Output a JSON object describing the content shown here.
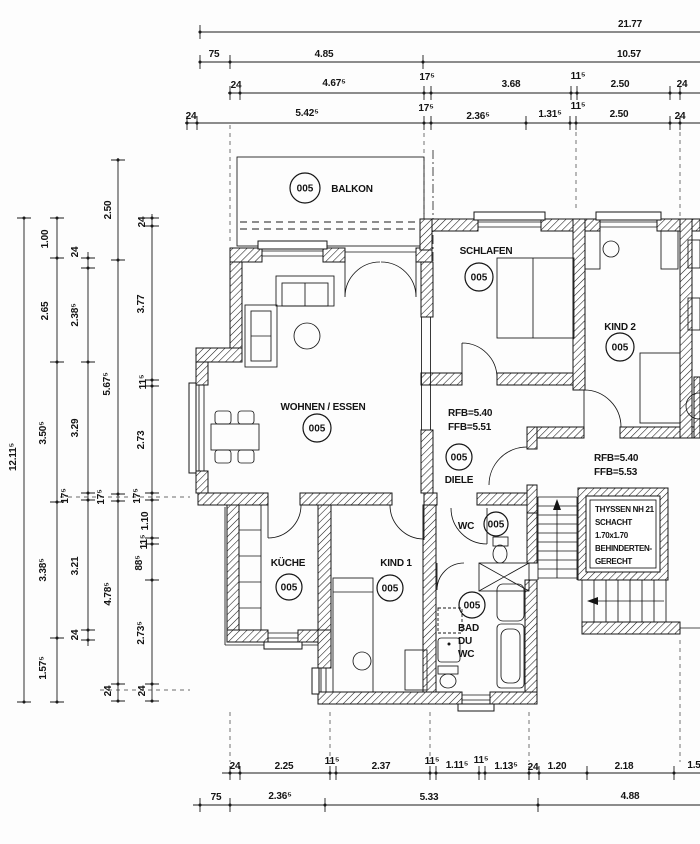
{
  "drawing_title": "Wohnungsgrundriss",
  "room_labels": [
    {
      "text": "BALKON",
      "x": 352,
      "y": 192
    },
    {
      "text": "SCHLAFEN",
      "x": 486,
      "y": 254
    },
    {
      "text": "KIND 2",
      "x": 620,
      "y": 330
    },
    {
      "text": "WOHNEN / ESSEN",
      "x": 323,
      "y": 410
    },
    {
      "text": "KÜCHE",
      "x": 288,
      "y": 566
    },
    {
      "text": "KIND 1",
      "x": 396,
      "y": 566
    },
    {
      "text": "DIELE",
      "x": 459,
      "y": 483
    },
    {
      "text": "WC",
      "x": 466,
      "y": 529
    }
  ],
  "room_tags": [
    {
      "text": "005",
      "x": 305,
      "y": 188,
      "r": 15
    },
    {
      "text": "005",
      "x": 479,
      "y": 277,
      "r": 14
    },
    {
      "text": "005",
      "x": 620,
      "y": 347,
      "r": 14
    },
    {
      "text": "005",
      "x": 317,
      "y": 428,
      "r": 14
    },
    {
      "text": "005",
      "x": 289,
      "y": 587,
      "r": 13
    },
    {
      "text": "005",
      "x": 390,
      "y": 588,
      "r": 13
    },
    {
      "text": "005",
      "x": 459,
      "y": 457,
      "r": 13
    },
    {
      "text": "005",
      "x": 496,
      "y": 524,
      "r": 12
    },
    {
      "text": "005",
      "x": 472,
      "y": 605,
      "r": 13
    }
  ],
  "annotations": [
    {
      "text": "RFB=5.40",
      "x": 448,
      "y": 416
    },
    {
      "text": "FFB=5.51",
      "x": 448,
      "y": 430
    },
    {
      "text": "RFB=5.40",
      "x": 594,
      "y": 461
    },
    {
      "text": "FFB=5.53",
      "x": 594,
      "y": 475
    },
    {
      "text": "BAD",
      "x": 458,
      "y": 631
    },
    {
      "text": "DU",
      "x": 458,
      "y": 644
    },
    {
      "text": "WC",
      "x": 458,
      "y": 657
    },
    {
      "text": "THYSSEN NH 21",
      "x": 595,
      "y": 512,
      "cls": "small"
    },
    {
      "text": "SCHACHT",
      "x": 595,
      "y": 525,
      "cls": "small"
    },
    {
      "text": "1.70x1.70",
      "x": 595,
      "y": 538,
      "cls": "small"
    },
    {
      "text": "BEHINDERTEN-",
      "x": 595,
      "y": 551,
      "cls": "small"
    },
    {
      "text": "GERECHT",
      "x": 595,
      "y": 564,
      "cls": "small"
    }
  ],
  "dims_top": [
    {
      "text": "21.77",
      "x": 630,
      "y": 27
    },
    {
      "text": "75",
      "x": 214,
      "y": 57
    },
    {
      "text": "4.85",
      "x": 324,
      "y": 57
    },
    {
      "text": "10.57",
      "x": 629,
      "y": 57
    },
    {
      "text": "24",
      "x": 236,
      "y": 88
    },
    {
      "text": "4.67⁵",
      "x": 334,
      "y": 86
    },
    {
      "text": "17⁵",
      "x": 427,
      "y": 80
    },
    {
      "text": "3.68",
      "x": 511,
      "y": 87
    },
    {
      "text": "11⁵",
      "x": 578,
      "y": 79
    },
    {
      "text": "2.50",
      "x": 620,
      "y": 87
    },
    {
      "text": "24",
      "x": 682,
      "y": 87
    },
    {
      "text": "24",
      "x": 191,
      "y": 119
    },
    {
      "text": "5.42⁵",
      "x": 307,
      "y": 116
    },
    {
      "text": "17⁵",
      "x": 426,
      "y": 111
    },
    {
      "text": "2.36⁵",
      "x": 478,
      "y": 119
    },
    {
      "text": "1.31⁵",
      "x": 550,
      "y": 117
    },
    {
      "text": "11⁵",
      "x": 578,
      "y": 109
    },
    {
      "text": "2.50",
      "x": 619,
      "y": 117
    },
    {
      "text": "24",
      "x": 680,
      "y": 119
    }
  ],
  "dims_bottom": [
    {
      "text": "24",
      "x": 235,
      "y": 769
    },
    {
      "text": "2.25",
      "x": 284,
      "y": 769
    },
    {
      "text": "11⁵",
      "x": 332,
      "y": 764
    },
    {
      "text": "2.37",
      "x": 381,
      "y": 769
    },
    {
      "text": "11⁵",
      "x": 432,
      "y": 764
    },
    {
      "text": "1.11⁵",
      "x": 457,
      "y": 768
    },
    {
      "text": "11⁵",
      "x": 481,
      "y": 763
    },
    {
      "text": "1.13⁵",
      "x": 506,
      "y": 769
    },
    {
      "text": "24",
      "x": 533,
      "y": 770
    },
    {
      "text": "1.20",
      "x": 557,
      "y": 769
    },
    {
      "text": "2.18",
      "x": 624,
      "y": 769
    },
    {
      "text": "1.5",
      "x": 694,
      "y": 768
    },
    {
      "text": "75",
      "x": 216,
      "y": 800
    },
    {
      "text": "2.36⁵",
      "x": 280,
      "y": 799
    },
    {
      "text": "5.33",
      "x": 429,
      "y": 800
    },
    {
      "text": "4.88",
      "x": 630,
      "y": 799
    }
  ],
  "dims_left": [
    {
      "text": "12.11⁵",
      "x": 16,
      "y": 457,
      "rot": -90
    },
    {
      "text": "1.00",
      "x": 48,
      "y": 239,
      "rot": -90
    },
    {
      "text": "2.65",
      "x": 48,
      "y": 311,
      "rot": -90
    },
    {
      "text": "3.50⁵",
      "x": 46,
      "y": 433,
      "rot": -90
    },
    {
      "text": "3.38⁵",
      "x": 46,
      "y": 570,
      "rot": -90
    },
    {
      "text": "1.57⁵",
      "x": 46,
      "y": 668,
      "rot": -90
    },
    {
      "text": "24",
      "x": 78,
      "y": 252,
      "rot": -90
    },
    {
      "text": "2.38⁵",
      "x": 78,
      "y": 315,
      "rot": -90
    },
    {
      "text": "3.29",
      "x": 78,
      "y": 428,
      "rot": -90
    },
    {
      "text": "17⁵",
      "x": 68,
      "y": 496,
      "rot": -90
    },
    {
      "text": "3.21",
      "x": 78,
      "y": 566,
      "rot": -90
    },
    {
      "text": "24",
      "x": 78,
      "y": 635,
      "rot": -90
    },
    {
      "text": "2.50",
      "x": 111,
      "y": 210,
      "rot": -90
    },
    {
      "text": "5.67⁵",
      "x": 110,
      "y": 384,
      "rot": -90
    },
    {
      "text": "17⁵",
      "x": 104,
      "y": 497,
      "rot": -90
    },
    {
      "text": "4.78⁵",
      "x": 111,
      "y": 594,
      "rot": -90
    },
    {
      "text": "24",
      "x": 111,
      "y": 691,
      "rot": -90
    },
    {
      "text": "24",
      "x": 145,
      "y": 222,
      "rot": -90
    },
    {
      "text": "3.77",
      "x": 144,
      "y": 304,
      "rot": -90
    },
    {
      "text": "11⁵",
      "x": 146,
      "y": 382,
      "rot": -90
    },
    {
      "text": "2.73",
      "x": 144,
      "y": 440,
      "rot": -90
    },
    {
      "text": "17⁵",
      "x": 140,
      "y": 496,
      "rot": -90
    },
    {
      "text": "1.10",
      "x": 148,
      "y": 521,
      "rot": -90
    },
    {
      "text": "11⁵",
      "x": 147,
      "y": 542,
      "rot": -90
    },
    {
      "text": "88⁵",
      "x": 142,
      "y": 563,
      "rot": -90
    },
    {
      "text": "2.73⁵",
      "x": 144,
      "y": 633,
      "rot": -90
    },
    {
      "text": "24",
      "x": 145,
      "y": 691,
      "rot": -90
    }
  ],
  "colors": {
    "ink": "#161616",
    "paper": "#fdfdfd"
  }
}
